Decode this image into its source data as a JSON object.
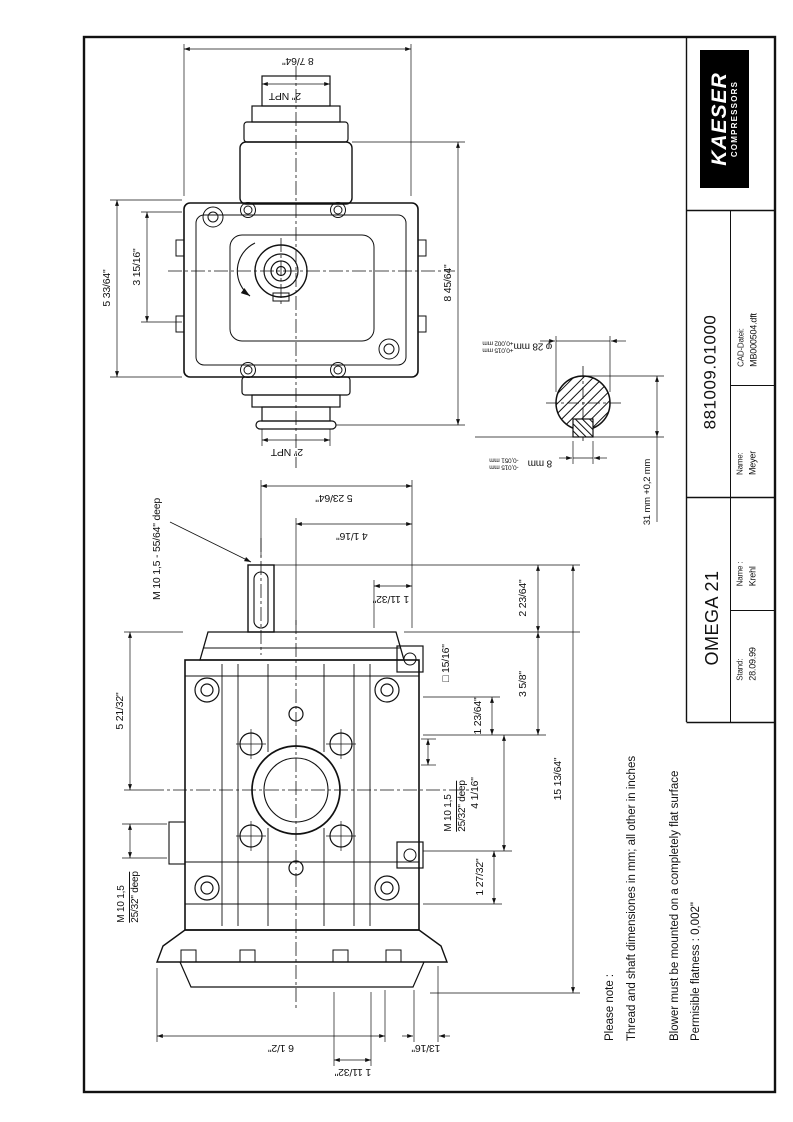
{
  "title_block": {
    "brand": "KAESER",
    "brand_sub": "COMPRESSORS",
    "drawing_number": "881009.01000",
    "cad_label": "CAD-Datei:",
    "cad_file": "MB000504.dft",
    "name_label_1": "Name:",
    "name_1": "Meyer",
    "name_label_2": "Name :",
    "name_2": "Krehl",
    "model": "OMEGA 21",
    "date_label": "Stand:",
    "date": "28.09.99"
  },
  "notes": {
    "line1": "Please note :",
    "line2": "Thread and shaft dimensiones in mm; all other in inches",
    "line3": "Blower must be mounted on a completely flat surface",
    "line4": "Permisible flatness : 0,002\""
  },
  "top_view": {
    "dim_width": "8 7/64\"",
    "dim_port_top": "2\" NPT",
    "dim_height_outer": "5 33/64\"",
    "dim_height_inner": "3 15/16\"",
    "dim_depth": "8 45/64\"",
    "dim_port_bottom": "2\" NPT"
  },
  "front_view": {
    "thread_top": "M 10 1,5 - 55/64\" deep",
    "dim_shaft_offset": "5 23/64\"",
    "dim_top_center": "4 1/16\"",
    "dim_top_small": "1 11/32\"",
    "dim_shaft_height": "2 23/64\"",
    "square_boss": "□ 15/16\"",
    "dim_flange_top": "3 5/8\"",
    "dim_bolt_top": "1 23/64\"",
    "dim_bolt_span": "4 1/16\"",
    "thread_side_l1": "M 10 1,5",
    "thread_side_l2": "25/32\" deep",
    "dim_bolt_bottom": "1 27/32\"",
    "dim_total_height": "15 13/64\"",
    "dim_left_height": "5 21/32\"",
    "thread_left_l1": "M 10 1,5",
    "thread_left_l2": "25/32\" deep",
    "dim_feet_width": "6 1/2\"",
    "dim_feet_offset": "13/16\"",
    "dim_feet_small": "1 11/32\""
  },
  "shaft_detail": {
    "dim_diameter": "φ 28 mm",
    "dia_tol_upper": "+0,015 mm",
    "dia_tol_lower": "+0,002 mm",
    "dim_key_width": "8 mm",
    "key_tol_upper": "-0,015 mm",
    "key_tol_lower": "-0,051 mm",
    "dim_over_key": "31 mm +0,2 mm"
  }
}
